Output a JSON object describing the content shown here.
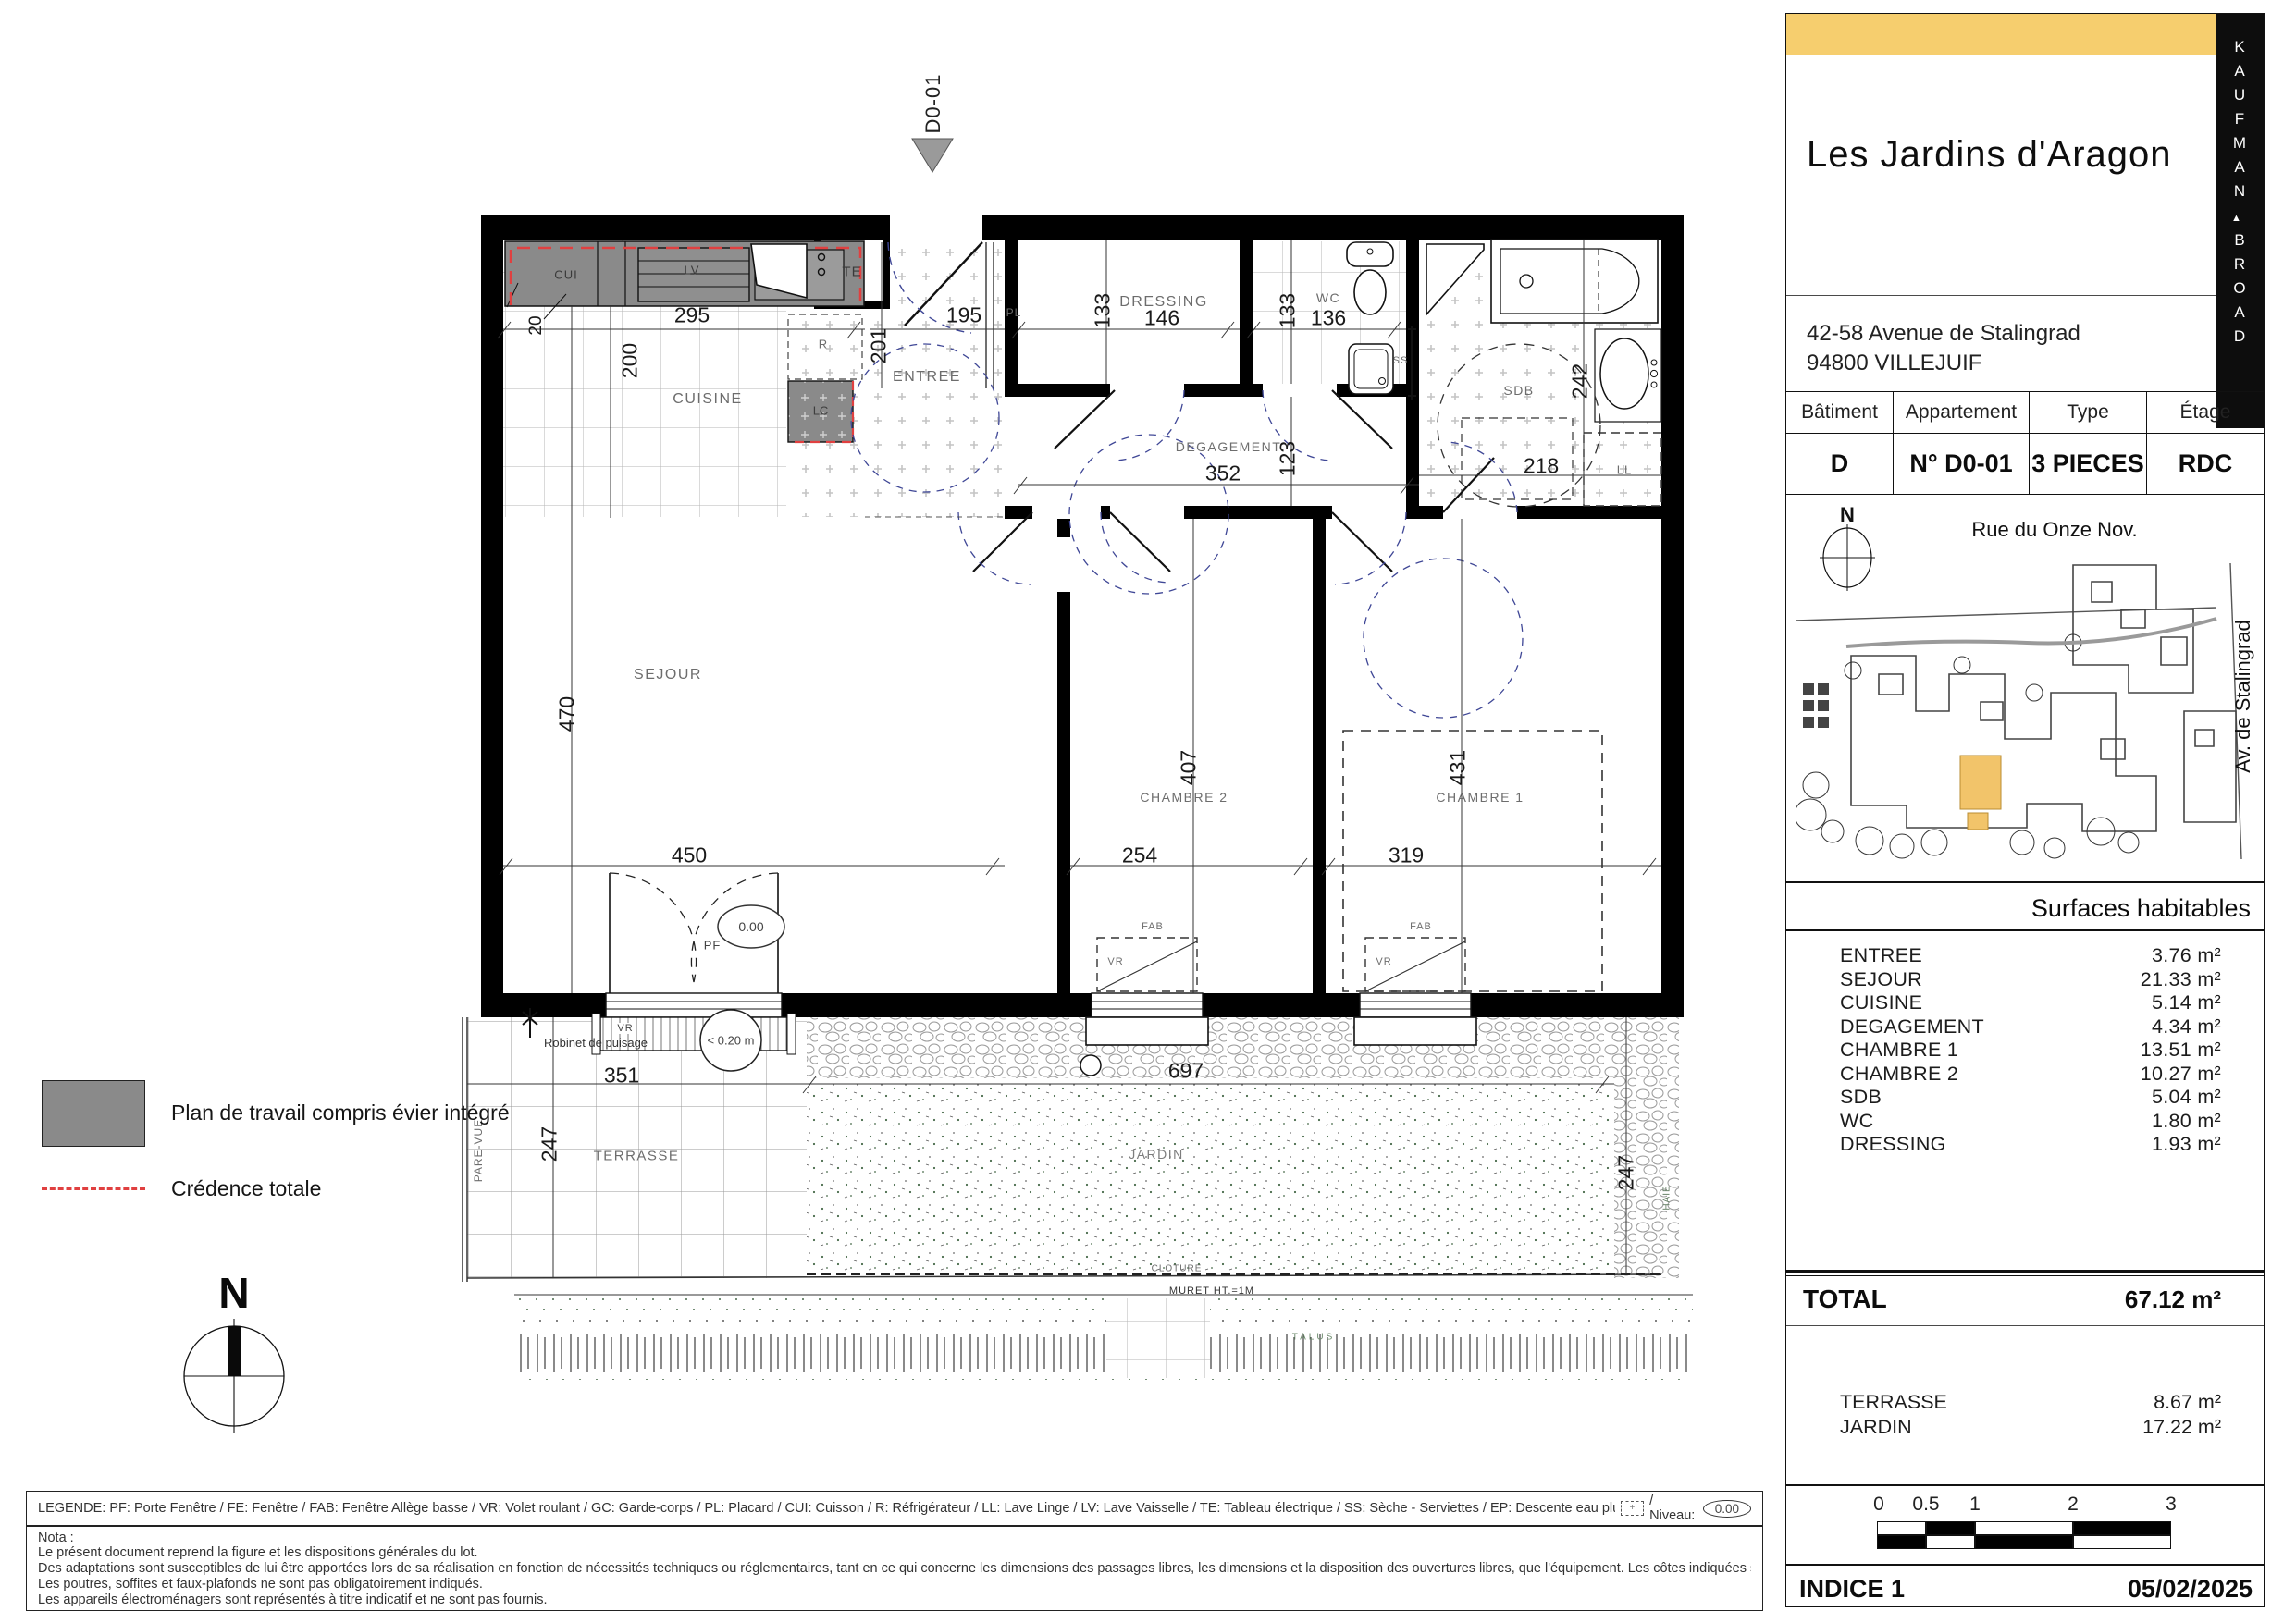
{
  "brand": {
    "word1": "KAUFMAN",
    "word2": "BROAD",
    "separator": "▲"
  },
  "panel": {
    "title": "Les Jardins d'Aragon",
    "address_line1": "42-58 Avenue de Stalingrad",
    "address_line2": "94800 VILLEJUIF",
    "info_table": {
      "headers": [
        "Bâtiment",
        "Appartement",
        "Type",
        "Étage"
      ],
      "values": [
        "D",
        "N° D0-01",
        "3 PIECES",
        "RDC"
      ]
    },
    "map": {
      "north_label": "N",
      "street_top": "Rue du Onze Nov.",
      "street_right": "Av. de Stalingrad"
    },
    "surfaces": {
      "header": "Surfaces habitables",
      "rows": [
        {
          "label": "ENTREE",
          "value": "3.76 m²"
        },
        {
          "label": "SEJOUR",
          "value": "21.33 m²"
        },
        {
          "label": "CUISINE",
          "value": "5.14 m²"
        },
        {
          "label": "DEGAGEMENT",
          "value": "4.34 m²"
        },
        {
          "label": "CHAMBRE 1",
          "value": "13.51 m²"
        },
        {
          "label": "CHAMBRE 2",
          "value": "10.27 m²"
        },
        {
          "label": "SDB",
          "value": "5.04 m²"
        },
        {
          "label": "WC",
          "value": "1.80 m²"
        },
        {
          "label": "DRESSING",
          "value": "1.93 m²"
        }
      ],
      "total_label": "TOTAL",
      "total_value": "67.12 m²",
      "annex_rows": [
        {
          "label": "TERRASSE",
          "value": "8.67 m²"
        },
        {
          "label": "JARDIN",
          "value": "17.22 m²"
        }
      ]
    },
    "scalebar": {
      "ticks": [
        "0",
        "0.5",
        "1",
        "2",
        "3"
      ]
    },
    "footer": {
      "indice": "INDICE 1",
      "date": "05/02/2025"
    }
  },
  "side_legend": {
    "worktop": "Plan de travail compris évier intégré",
    "credence": "Crédence totale",
    "north": "N"
  },
  "bottom": {
    "legende": "LEGENDE: PF: Porte Fenêtre / FE: Fenêtre / FAB: Fenêtre Allège basse / VR: Volet roulant / GC: Garde-corps / PL: Placard / CUI: Cuisson / R: Réfrigérateur / LL: Lave Linge / LV: Lave Vaisselle / TE: Tableau électrique / SS: Sèche - Serviettes / EP: Descente eau pluviale / Soffite, faux-plafonds:",
    "soffit_icon": "+",
    "legende_niveau": "/ Niveau:",
    "legende_niveau_value": "0.00",
    "nota_title": "Nota :",
    "nota_line1": "Le présent document reprend la figure et les dispositions générales du lot.",
    "nota_line2": "Des adaptations sont susceptibles de lui être apportées lors de sa réalisation en fonction de nécessités techniques ou réglementaires, tant en ce qui concerne les dimensions des passages libres, les dimensions et la disposition des ouvertures libres, que l'équipement. Les côtes indiquées sont approximatives.",
    "nota_line3": "Les poutres, soffites et faux-plafonds ne sont pas obligatoirement indiqués.",
    "nota_line4": "Les appareils électroménagers sont représentés à titre indicatif et ne sont pas fournis."
  },
  "plan": {
    "unit_tag": "D0-01",
    "rooms": {
      "cuisine": "CUISINE",
      "entree": "ENTREE",
      "dressing": "DRESSING",
      "wc": "WC",
      "sdb": "SDB",
      "degagement": "DEGAGEMENT",
      "sejour": "SEJOUR",
      "chambre1": "CHAMBRE 1",
      "chambre2": "CHAMBRE 2",
      "terrasse": "TERRASSE",
      "jardin": "JARDIN"
    },
    "tags": {
      "cui": "CUI",
      "lv": "LV",
      "te": "TE",
      "r": "R",
      "lc": "LC",
      "pl": "PL",
      "ss": "SS",
      "ll": "LL",
      "pf": "PF",
      "vr": "VR",
      "fab": "FAB",
      "pare_vue": "PARE-VUE",
      "cloture": "CLOTURE",
      "muret": "MURET HT.=1M",
      "talus": "TALUS",
      "haie": "HAIE",
      "robinet": "Robinet de puisage",
      "niveau": "0.00",
      "seuil": "< 0.20 m"
    },
    "dims": {
      "d20": "20",
      "d295": "295",
      "d200": "200",
      "d195": "195",
      "d201": "201",
      "d146": "146",
      "d133a": "133",
      "d133b": "133",
      "d136": "136",
      "d352": "352",
      "d123": "123",
      "d242": "242",
      "d218": "218",
      "d470": "470",
      "d450": "450",
      "d407": "407",
      "d254": "254",
      "d431": "431",
      "d319": "319",
      "d351": "351",
      "d247a": "247",
      "d697": "697",
      "d247b": "247"
    }
  },
  "colors": {
    "accent_yellow": "#F6CE6E",
    "wall_black": "#000000",
    "counter_gray": "#8A8A8A",
    "credence_red": "#E04040",
    "site_highlight": "#F2C46A"
  }
}
